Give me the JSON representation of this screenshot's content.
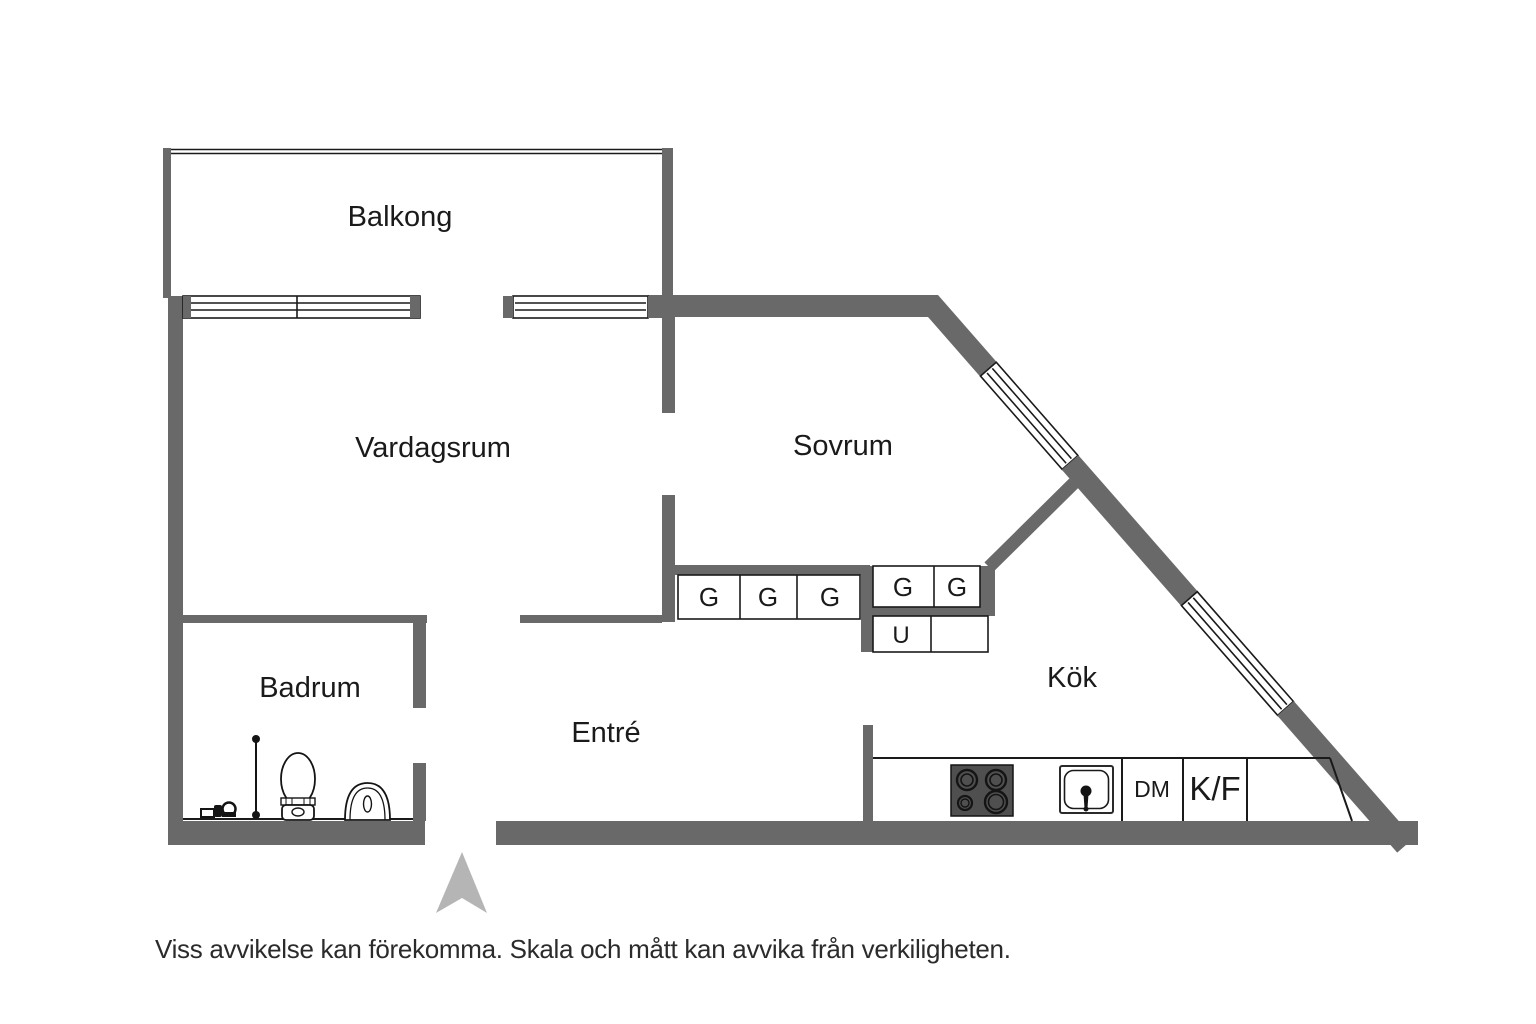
{
  "rooms": {
    "balcony": "Balkong",
    "living_room": "Vardagsrum",
    "bedroom": "Sovrum",
    "bathroom": "Badrum",
    "entry": "Entré",
    "kitchen": "Kök"
  },
  "cabinets": {
    "g1": "G",
    "g2": "G",
    "g3": "G",
    "g4": "G",
    "g5": "G",
    "u": "U"
  },
  "appliances": {
    "dishwasher": "DM",
    "fridge_freezer": "K/F"
  },
  "disclaimer": "Viss avvikelse kan förekomma. Skala och mått kan avvika från verkiligheten.",
  "colors": {
    "wall": "#696969",
    "line": "#1a1a1a",
    "arrow": "#b5b5b5",
    "stove": "#4f4f4f",
    "background": "#ffffff"
  },
  "icons": {
    "entrance_arrow": "entrance-arrow",
    "stove": "stove-hob-icon",
    "sink": "sink-icon",
    "toilet": "toilet-icon",
    "washbasin": "washbasin-icon",
    "shower_rail": "shower-rail-icon",
    "floor_drain": "floor-drain-icon"
  }
}
